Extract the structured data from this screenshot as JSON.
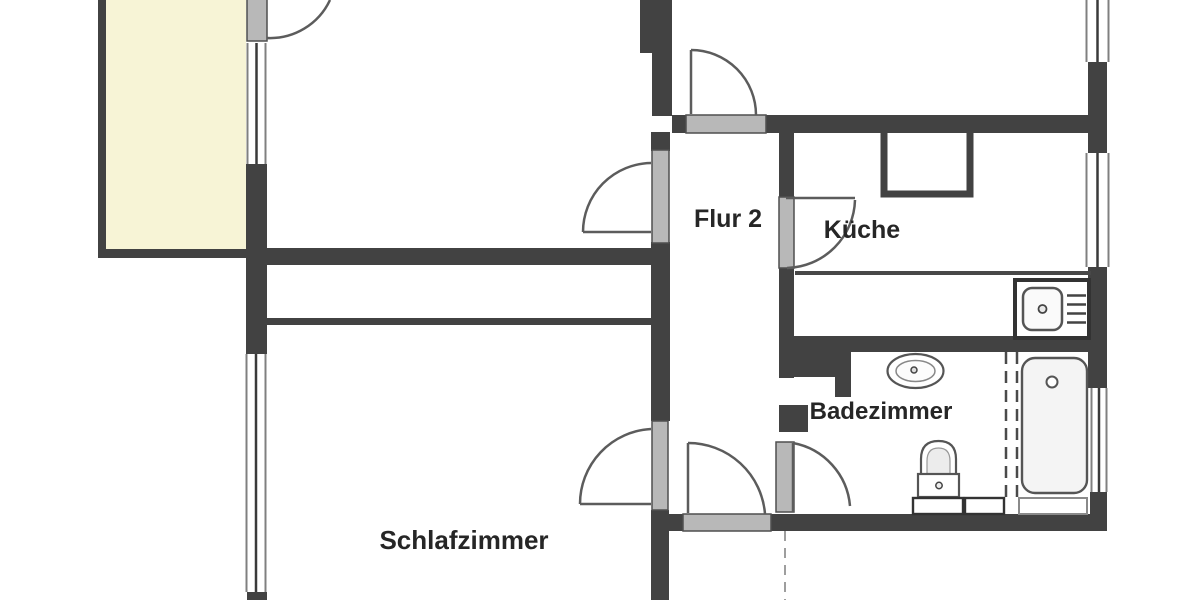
{
  "floorplan": {
    "type": "apartment-floor-plan",
    "rooms": [
      {
        "id": "flur-2",
        "label": "Flur 2"
      },
      {
        "id": "kueche",
        "label": "Küche"
      },
      {
        "id": "badezimmer",
        "label": "Badezimmer"
      },
      {
        "id": "schlafzimmer",
        "label": "Schlafzimmer"
      }
    ],
    "fixtures": [
      "balcony",
      "bathtub",
      "toilet",
      "washbasin",
      "kitchen-sink",
      "stove-counter",
      "shower-partition",
      "windows",
      "door-swings"
    ],
    "colors": {
      "background": "#ffffff",
      "wall": "#424242",
      "door_fill": "#b8b8b8",
      "door_edge": "#4f4f4f",
      "balcony_fill": "#f7f4d6",
      "swing_line": "#5c5c5c",
      "fixture_line": "#555555",
      "label_text": "#262626"
    }
  }
}
